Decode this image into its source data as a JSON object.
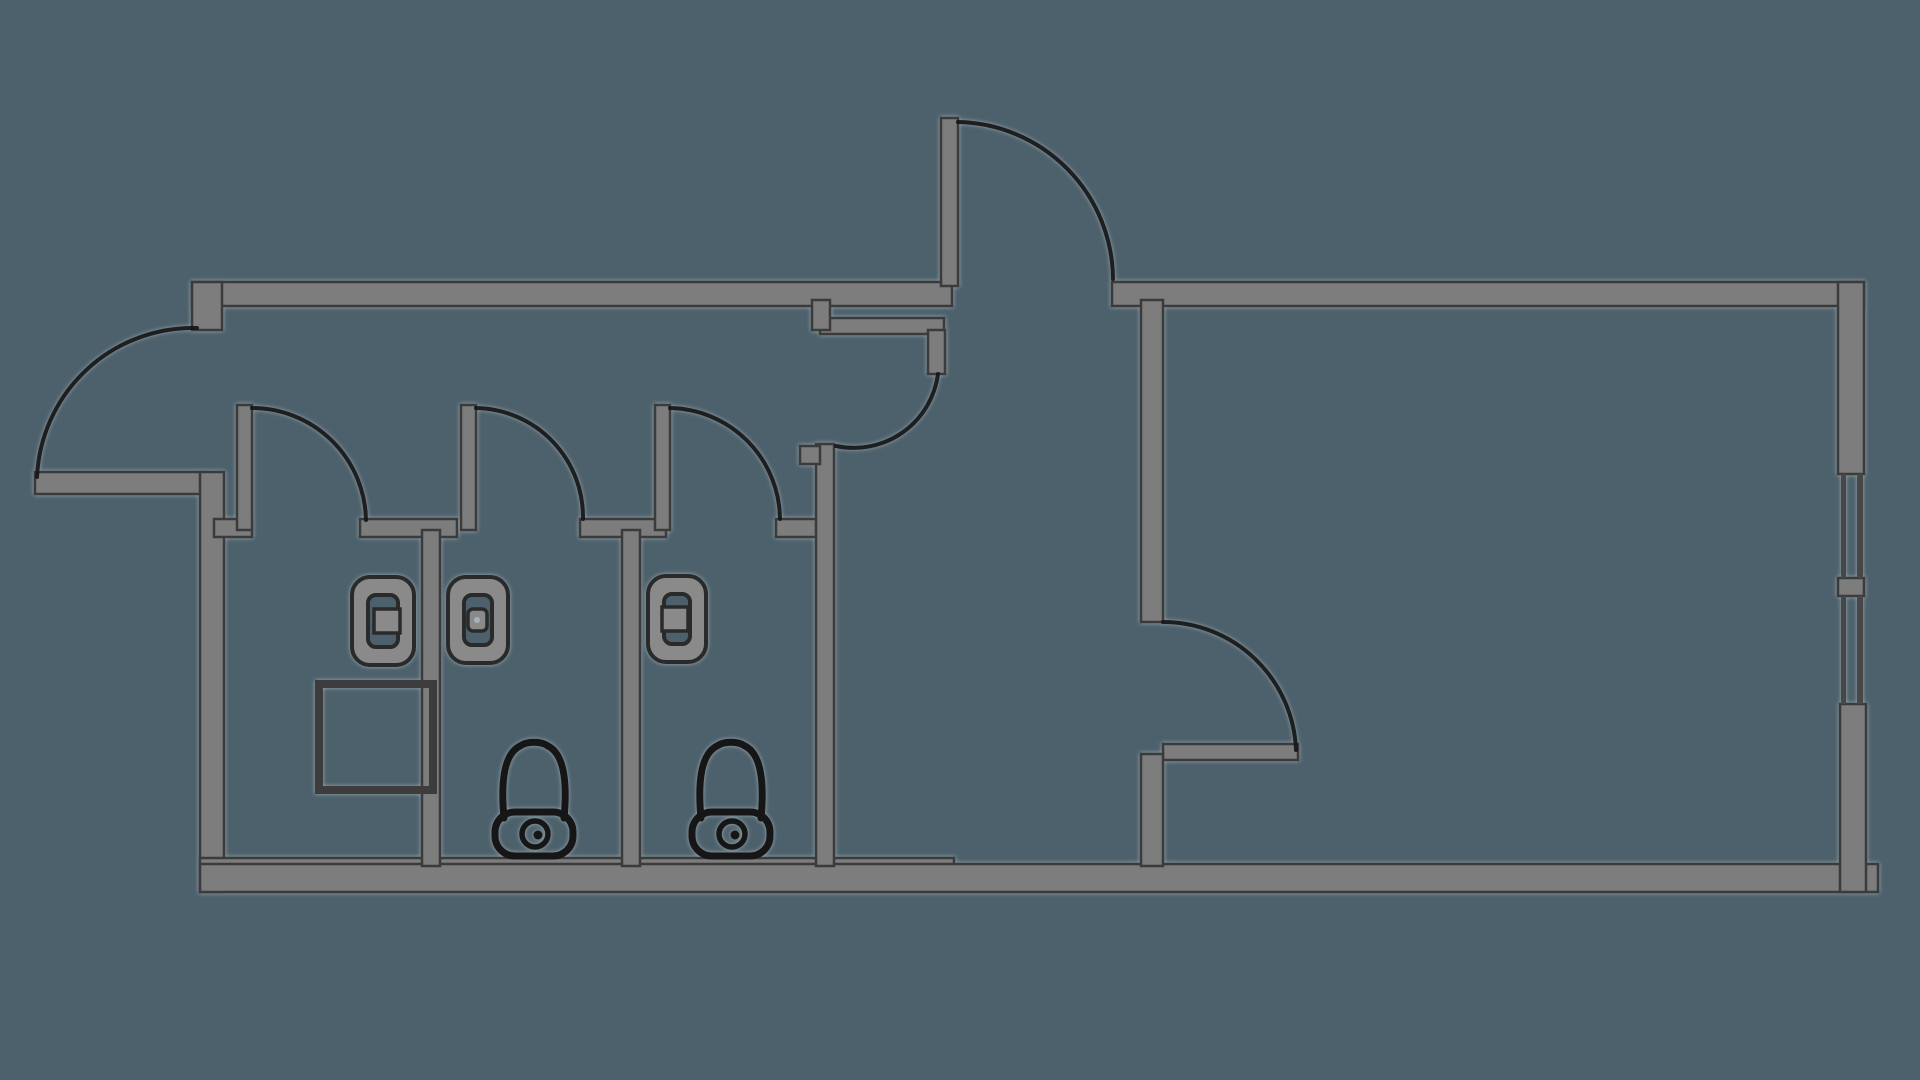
{
  "canvas": {
    "width": 1920,
    "height": 1080,
    "background": "#4d616c",
    "wall_fill": "#7d7d7d",
    "wall_edge": "#3b3b3b",
    "fixture_fill": "#8a8a8a",
    "line_color": "#161616",
    "thin_line_color": "#3c3c3c",
    "window_line_color": "#474747"
  },
  "plan": {
    "walls": [
      {
        "name": "top-wall-left-section",
        "x": 192,
        "y": 282,
        "w": 760,
        "h": 24
      },
      {
        "name": "entrance-jamb-west",
        "x": 192,
        "y": 282,
        "w": 30,
        "h": 48
      },
      {
        "name": "west-door-leaf",
        "x": 35,
        "y": 472,
        "w": 166,
        "h": 22
      },
      {
        "name": "left-outer-wall",
        "x": 200,
        "y": 472,
        "w": 24,
        "h": 420
      },
      {
        "name": "bottom-wall-step",
        "x": 200,
        "y": 858,
        "w": 754,
        "h": 10
      },
      {
        "name": "bottom-outer-wall",
        "x": 200,
        "y": 864,
        "w": 1678,
        "h": 28
      },
      {
        "name": "top-wall-right-section",
        "x": 1112,
        "y": 282,
        "w": 752,
        "h": 24
      },
      {
        "name": "right-outer-wall-upper",
        "x": 1838,
        "y": 282,
        "w": 26,
        "h": 192
      },
      {
        "name": "window-mullion",
        "x": 1838,
        "y": 578,
        "w": 26,
        "h": 18
      },
      {
        "name": "right-outer-wall-lower",
        "x": 1840,
        "y": 704,
        "w": 26,
        "h": 188
      },
      {
        "name": "north-door-leaf",
        "x": 941,
        "y": 118,
        "w": 17,
        "h": 168
      },
      {
        "name": "stall-stub-left",
        "x": 214,
        "y": 519,
        "w": 38,
        "h": 18
      },
      {
        "name": "stall-door-leaf-1",
        "x": 237,
        "y": 405,
        "w": 15,
        "h": 125
      },
      {
        "name": "stall-stub-mid-1",
        "x": 360,
        "y": 519,
        "w": 97,
        "h": 18
      },
      {
        "name": "stall-divider-1",
        "x": 422,
        "y": 530,
        "w": 18,
        "h": 336
      },
      {
        "name": "stall-door-leaf-2",
        "x": 461,
        "y": 405,
        "w": 15,
        "h": 125
      },
      {
        "name": "stall-stub-mid-2",
        "x": 580,
        "y": 519,
        "w": 86,
        "h": 18
      },
      {
        "name": "stall-divider-2",
        "x": 622,
        "y": 530,
        "w": 18,
        "h": 336
      },
      {
        "name": "stall-door-leaf-3",
        "x": 655,
        "y": 405,
        "w": 15,
        "h": 125
      },
      {
        "name": "stall-stub-mid-3",
        "x": 776,
        "y": 519,
        "w": 52,
        "h": 18
      },
      {
        "name": "stall-right-wall",
        "x": 816,
        "y": 444,
        "w": 18,
        "h": 422
      },
      {
        "name": "stall-right-wall-tab",
        "x": 800,
        "y": 446,
        "w": 20,
        "h": 18
      },
      {
        "name": "hall-partition-top",
        "x": 820,
        "y": 318,
        "w": 124,
        "h": 16
      },
      {
        "name": "hall-partition-notch",
        "x": 812,
        "y": 300,
        "w": 18,
        "h": 30
      },
      {
        "name": "hall-door-jamb-stub",
        "x": 928,
        "y": 330,
        "w": 17,
        "h": 44
      },
      {
        "name": "room-left-wall-upper",
        "x": 1141,
        "y": 300,
        "w": 22,
        "h": 322
      },
      {
        "name": "room-door-leaf",
        "x": 1163,
        "y": 744,
        "w": 135,
        "h": 16
      },
      {
        "name": "room-left-wall-lower",
        "x": 1141,
        "y": 754,
        "w": 22,
        "h": 112
      }
    ],
    "window_lines": [
      {
        "name": "window-pane-line",
        "x": 1841,
        "y": 474,
        "w": 5,
        "h": 104
      },
      {
        "name": "window-pane-line",
        "x": 1857,
        "y": 474,
        "w": 6,
        "h": 104
      },
      {
        "name": "window-pane-line",
        "x": 1841,
        "y": 596,
        "w": 5,
        "h": 108
      },
      {
        "name": "window-pane-line",
        "x": 1857,
        "y": 596,
        "w": 6,
        "h": 108
      }
    ],
    "door_arcs": [
      {
        "name": "west-entrance-door-arc",
        "d": "M 197,328 A 156,156 0 0 0 37,477"
      },
      {
        "name": "north-entrance-door-arc",
        "d": "M 958,122 A 158,158 0 0 1 1113,279"
      },
      {
        "name": "stall-door-arc-1",
        "d": "M 252,408 A 114,114 0 0 1 366,520"
      },
      {
        "name": "stall-door-arc-2",
        "d": "M 476,408 A 109,109 0 0 1 583,519"
      },
      {
        "name": "stall-door-arc-3",
        "d": "M 670,408 A 112,112 0 0 1 780,519"
      },
      {
        "name": "hall-door-arc",
        "d": "M 938,374 A 85,85 0 0 1 836,446"
      },
      {
        "name": "room-door-arc",
        "d": "M 1163,622 A 133,133 0 0 1 1296,750"
      }
    ],
    "closet": {
      "name": "corner-closet",
      "x": 315,
      "y": 680,
      "w": 122,
      "h": 114
    },
    "sinks": [
      {
        "name": "sink-1",
        "x": 352,
        "y": 577,
        "w": 62,
        "h": 88,
        "detail": "tab-right"
      },
      {
        "name": "sink-2",
        "x": 448,
        "y": 577,
        "w": 60,
        "h": 86,
        "detail": "knob"
      },
      {
        "name": "sink-3",
        "x": 648,
        "y": 576,
        "w": 58,
        "h": 86,
        "detail": "tab-left"
      }
    ],
    "toilets": [
      {
        "name": "toilet-1",
        "cx": 534
      },
      {
        "name": "toilet-2",
        "cx": 731
      }
    ]
  }
}
